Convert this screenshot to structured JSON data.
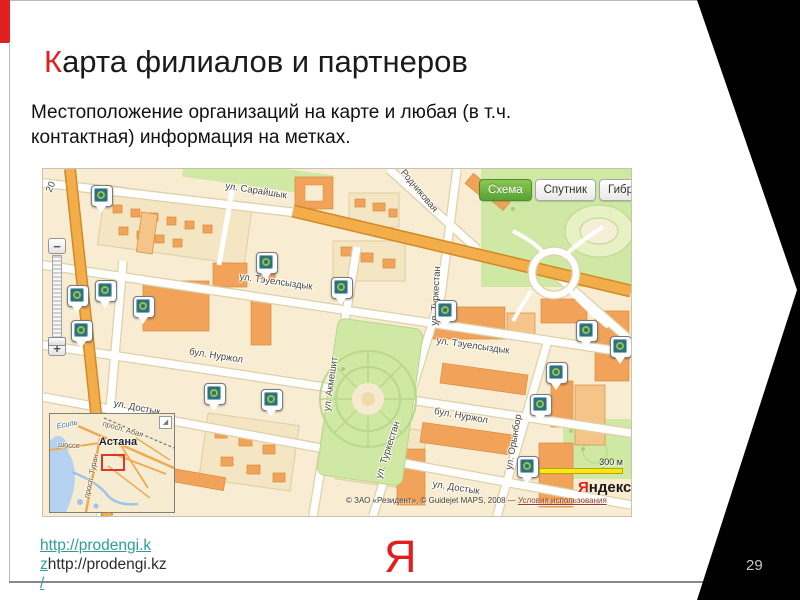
{
  "slide": {
    "title": {
      "first_letter": "К",
      "rest": "арта филиалов и партнеров"
    },
    "subtitle": "Местоположение организаций на карте и любая (в т.ч. контактная) информация на метках.",
    "page_number": "29",
    "footer": {
      "link_line1": "http://prodengi.k",
      "link_line2_linked": "z",
      "link_line2_plain": "http://prodengi.kz",
      "link_line3": "/",
      "logo_letter": "Я"
    }
  },
  "colors": {
    "accent_red": "#e01f1f",
    "link_teal": "#2e9d9a",
    "scheme_button_green": "#57a334",
    "marker_teal": "#2f6f83",
    "marker_ring_green": "#8fc43c",
    "scale_yellow": "#ffe715",
    "map_background": "#f8edd2"
  },
  "map": {
    "type_buttons": [
      {
        "label": "Схема",
        "active": true
      },
      {
        "label": "Спутник",
        "active": false
      },
      {
        "label": "Гибрид",
        "active": false
      }
    ],
    "zoom_control": {
      "zoom_in": "+",
      "zoom_out": "−"
    },
    "scale": {
      "label": "300 м"
    },
    "logo": {
      "first": "Я",
      "rest": "ндекс"
    },
    "copyright": {
      "text": "© ЗАО «Резидент», © Guidejet MAPS, 2008 — ",
      "link": "Условия использования"
    },
    "street_labels": [
      {
        "text": "ул. Сарайшык",
        "x": 213,
        "y": 22,
        "rot": 9
      },
      {
        "text": "Родниковая",
        "x": 376,
        "y": 22,
        "rot": 50
      },
      {
        "text": "ул. Тэуелсыздык",
        "x": 233,
        "y": 113,
        "rot": 8
      },
      {
        "text": "ул. Тэуелсыздык",
        "x": 430,
        "y": 177,
        "rot": 8
      },
      {
        "text": "бул. Нуржол",
        "x": 173,
        "y": 187,
        "rot": 9
      },
      {
        "text": "бул. Нуржол",
        "x": 418,
        "y": 247,
        "rot": 10
      },
      {
        "text": "ул. Достык",
        "x": 94,
        "y": 239,
        "rot": 11
      },
      {
        "text": "ул. Достык",
        "x": 413,
        "y": 319,
        "rot": 9
      },
      {
        "text": "ул. Акмешит",
        "x": 288,
        "y": 215,
        "rot": -82
      },
      {
        "text": "ул. Туркестан",
        "x": 393,
        "y": 127,
        "rot": -87
      },
      {
        "text": "ул. Туркестан",
        "x": 345,
        "y": 281,
        "rot": -72
      },
      {
        "text": "ул. Орынбор",
        "x": 471,
        "y": 273,
        "rot": -80
      },
      {
        "text": "20",
        "x": 8,
        "y": 18,
        "rot": -65
      }
    ],
    "markers": [
      {
        "x": 59,
        "y": 28
      },
      {
        "x": 224,
        "y": 95
      },
      {
        "x": 299,
        "y": 120
      },
      {
        "x": 35,
        "y": 128
      },
      {
        "x": 63,
        "y": 123
      },
      {
        "x": 39,
        "y": 163
      },
      {
        "x": 101,
        "y": 139
      },
      {
        "x": 403,
        "y": 143
      },
      {
        "x": 544,
        "y": 163
      },
      {
        "x": 578,
        "y": 179
      },
      {
        "x": 514,
        "y": 205
      },
      {
        "x": 498,
        "y": 237
      },
      {
        "x": 172,
        "y": 226
      },
      {
        "x": 229,
        "y": 232
      },
      {
        "x": 485,
        "y": 299
      }
    ],
    "inset": {
      "collapse_icon": "◢",
      "labels": [
        {
          "text": "Есиль",
          "x": 17,
          "y": 10,
          "rot": -12,
          "kind": "water"
        },
        {
          "text": "просп. Абая",
          "x": 73,
          "y": 15,
          "rot": 16,
          "kind": "road"
        },
        {
          "text": "шоссе",
          "x": 19,
          "y": 31,
          "rot": 3,
          "kind": "road"
        },
        {
          "text": "Астана",
          "x": 68,
          "y": 28,
          "rot": 0,
          "kind": "city"
        },
        {
          "text": "просп. Туран",
          "x": 41,
          "y": 62,
          "rot": -78,
          "kind": "road"
        }
      ]
    }
  }
}
